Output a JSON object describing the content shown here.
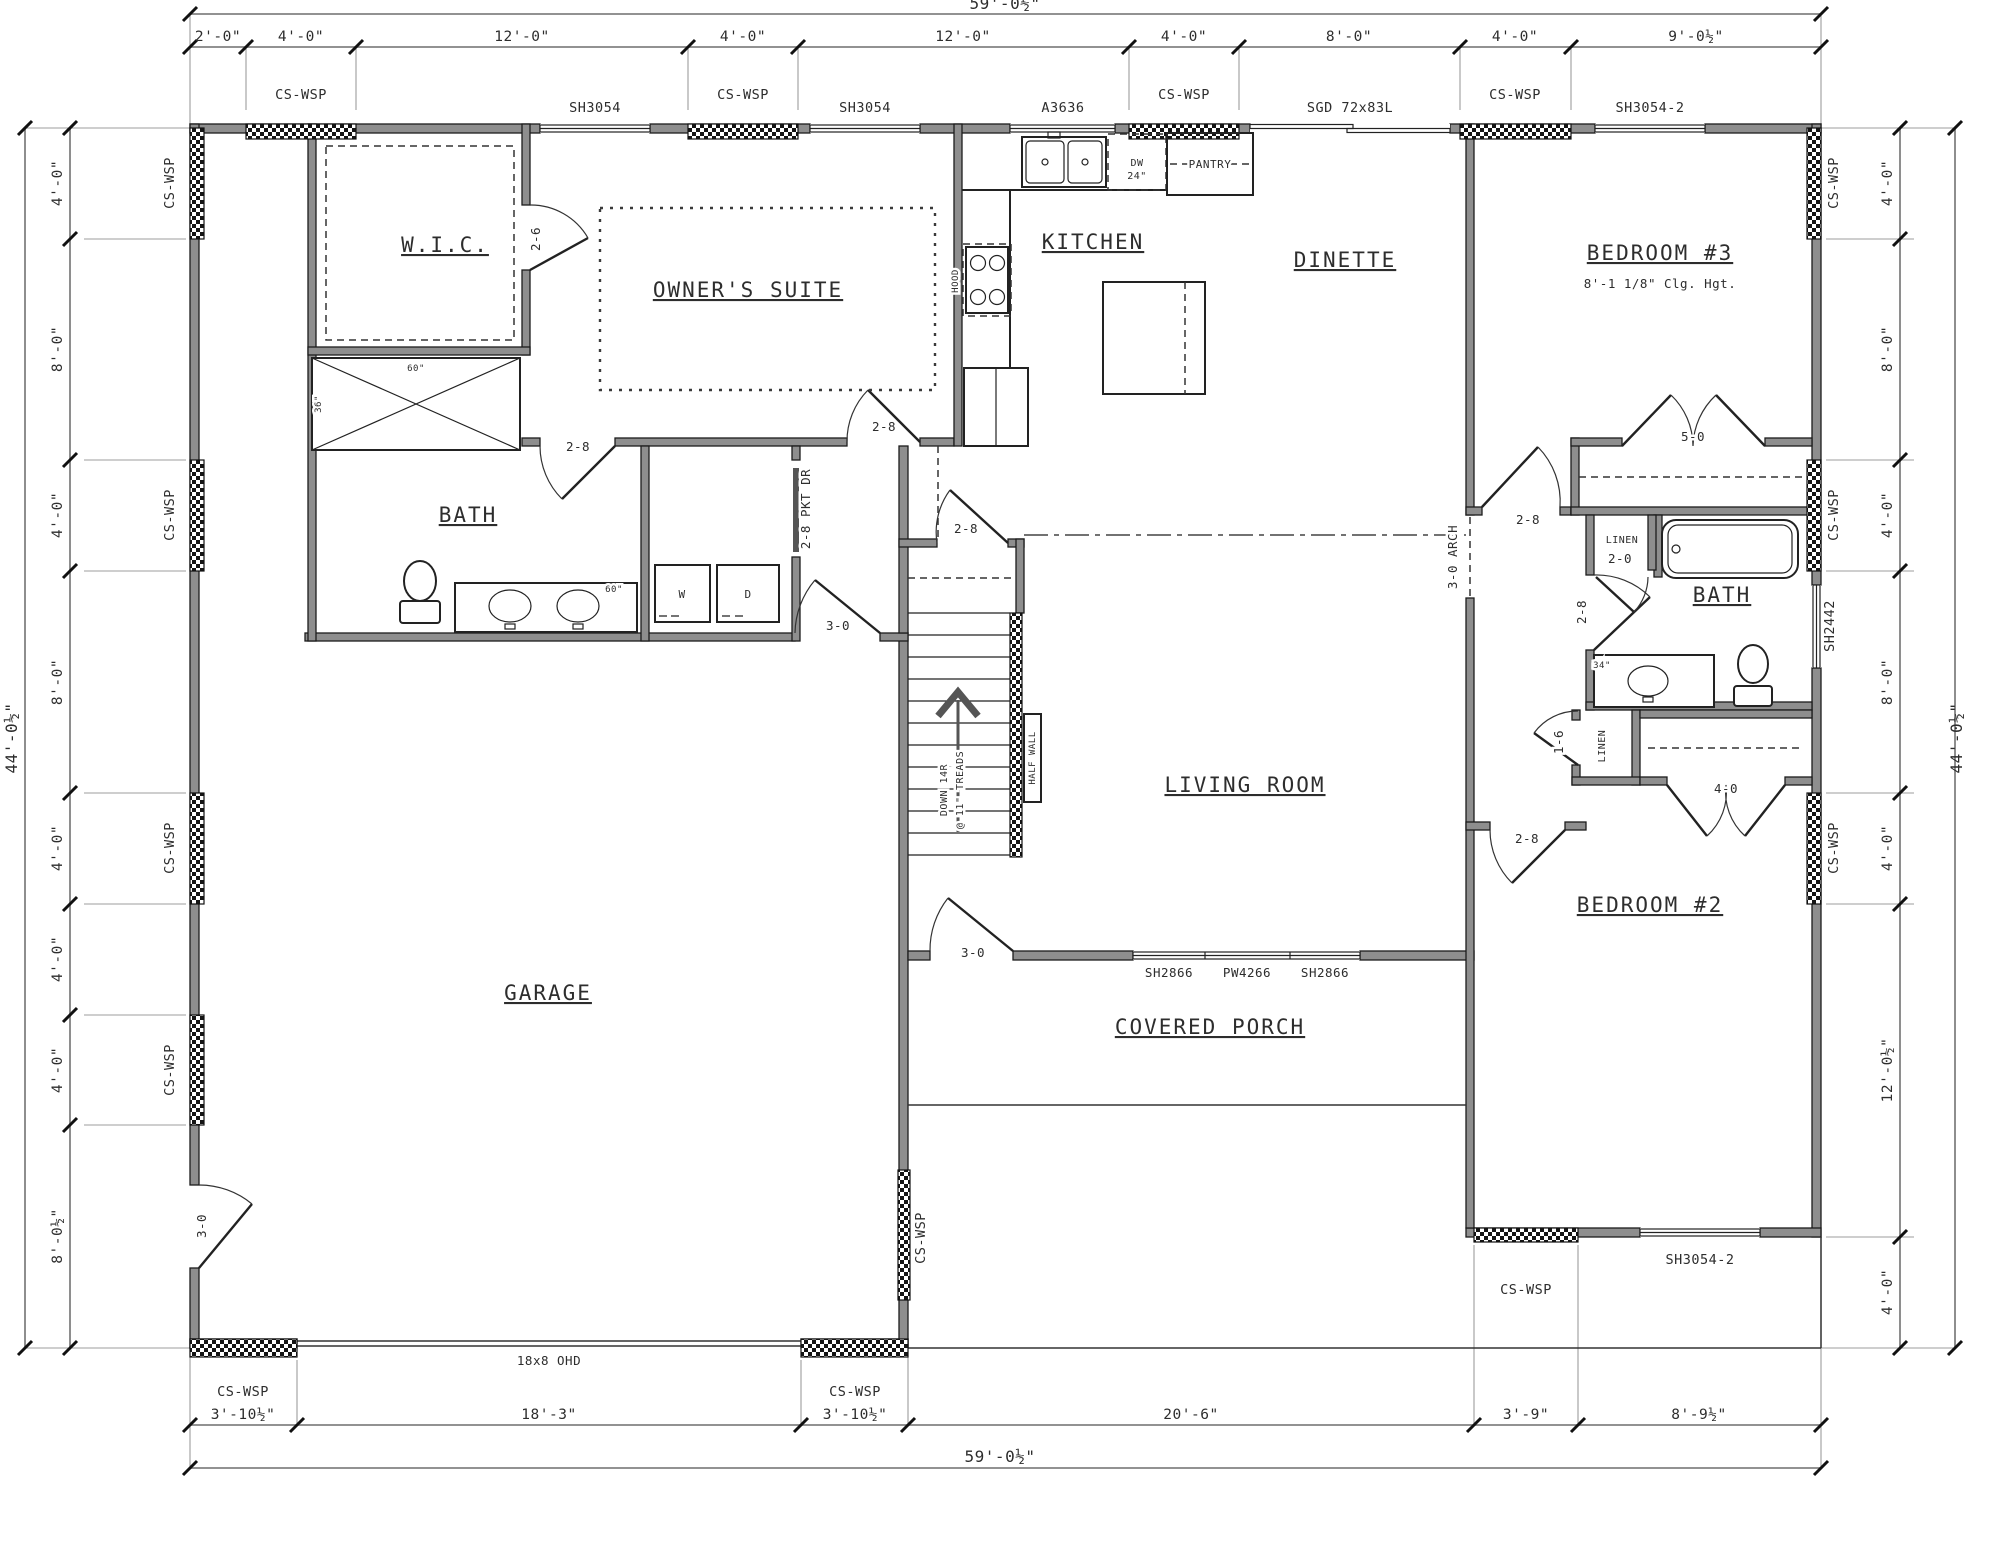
{
  "dims": {
    "top_overall": "59'-0½\"",
    "top": [
      "2'-0\"",
      "4'-0\"",
      "12'-0\"",
      "4'-0\"",
      "12'-0\"",
      "4'-0\"",
      "8'-0\"",
      "4'-0\"",
      "9'-0½\""
    ],
    "bottom": [
      "3'-10½\"",
      "18'-3\"",
      "3'-10½\"",
      "20'-6\"",
      "3'-9\"",
      "8'-9½\""
    ],
    "bottom_overall": "59'-0½\"",
    "left": [
      "4'-0\"",
      "8'-0\"",
      "4'-0\"",
      "8'-0\"",
      "4'-0\"",
      "4'-0\"",
      "4'-0\"",
      "8'-0½\""
    ],
    "left_overall": "44'-0½\"",
    "right": [
      "4'-0\"",
      "8'-0\"",
      "4'-0\"",
      "8'-0\"",
      "4'-0\"",
      "12'-0½\"",
      "4'-0\""
    ],
    "right_overall": "44'-0½\""
  },
  "rooms": {
    "wic": "W.I.C.",
    "owners_suite": "OWNER'S SUITE",
    "bath1": "BATH",
    "kitchen": "KITCHEN",
    "dinette": "DINETTE",
    "living": "LIVING ROOM",
    "garage": "GARAGE",
    "porch": "COVERED PORCH",
    "bed3": "BEDROOM #3",
    "bed3_note": "8'-1 1/8\" Clg. Hgt.",
    "bath2": "BATH",
    "bed2": "BEDROOM #2"
  },
  "openings": {
    "cs_wsp": "CS-WSP",
    "sh3054": "SH3054",
    "sh3054_2": "SH3054-2",
    "a3636": "A3636",
    "sgd": "SGD 72x83L",
    "sh2442": "SH2442",
    "sh2866": "SH2866",
    "pw4266": "PW4266",
    "ohd": "18x8 OHD",
    "d26": "2-6",
    "d28": "2-8",
    "d30": "3-0",
    "d20": "2-0",
    "d16": "1-6",
    "d40": "4-0",
    "d50": "5-0",
    "pkt": "2-8 PKT DR",
    "arch": "3-0 ARCH"
  },
  "fixtures": {
    "pantry": "PANTRY",
    "dw": "DW",
    "dw_size": "24\"",
    "washer": "W",
    "dryer": "D",
    "hood": "HOOD",
    "half_wall": "HALF WALL",
    "stairs_down": "DOWN 14R",
    "stairs_treads": "@ 11\" TREADS",
    "shower_w": "60\"",
    "shower_d": "36\"",
    "vanity_owner": "60\"",
    "vanity_bath2": "34\"",
    "linen": "LINEN"
  }
}
